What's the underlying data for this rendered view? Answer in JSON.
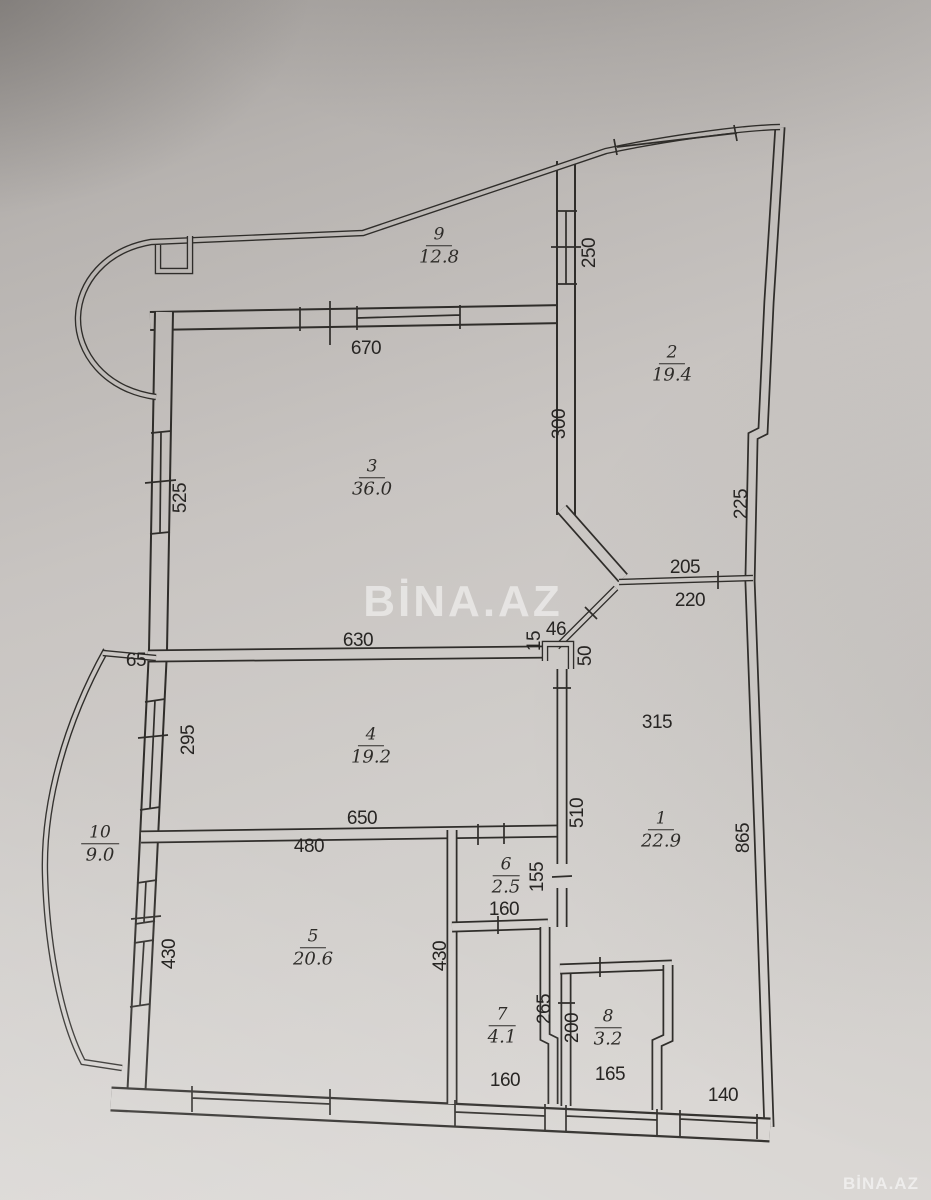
{
  "watermarks": {
    "center": "BİNA.AZ",
    "corner": "BİNA.AZ"
  },
  "rooms": {
    "r1": {
      "num": "1",
      "area": "22.9"
    },
    "r2": {
      "num": "2",
      "area": "19.4"
    },
    "r3": {
      "num": "3",
      "area": "36.0"
    },
    "r4": {
      "num": "4",
      "area": "19.2"
    },
    "r5": {
      "num": "5",
      "area": "20.6"
    },
    "r6": {
      "num": "6",
      "area": "2.5"
    },
    "r7": {
      "num": "7",
      "area": "4.1"
    },
    "r8": {
      "num": "8",
      "area": "3.2"
    },
    "r9": {
      "num": "9",
      "area": "12.8"
    },
    "r10": {
      "num": "10",
      "area": "9.0"
    }
  },
  "dims": {
    "d670": "670",
    "d250": "250",
    "d300": "300",
    "d525": "525",
    "d225": "225",
    "d205": "205",
    "d220": "220",
    "d630": "630",
    "d46": "46",
    "d15": "15",
    "d50": "50",
    "d65": "65",
    "d295": "295",
    "d315": "315",
    "d510": "510",
    "d865": "865",
    "d650": "650",
    "d480": "480",
    "d155": "155",
    "d160_mid": "160",
    "d430_left": "430",
    "d430_mid": "430",
    "d265": "265",
    "d200": "200",
    "d160_bottom": "160",
    "d165": "165",
    "d140": "140"
  }
}
